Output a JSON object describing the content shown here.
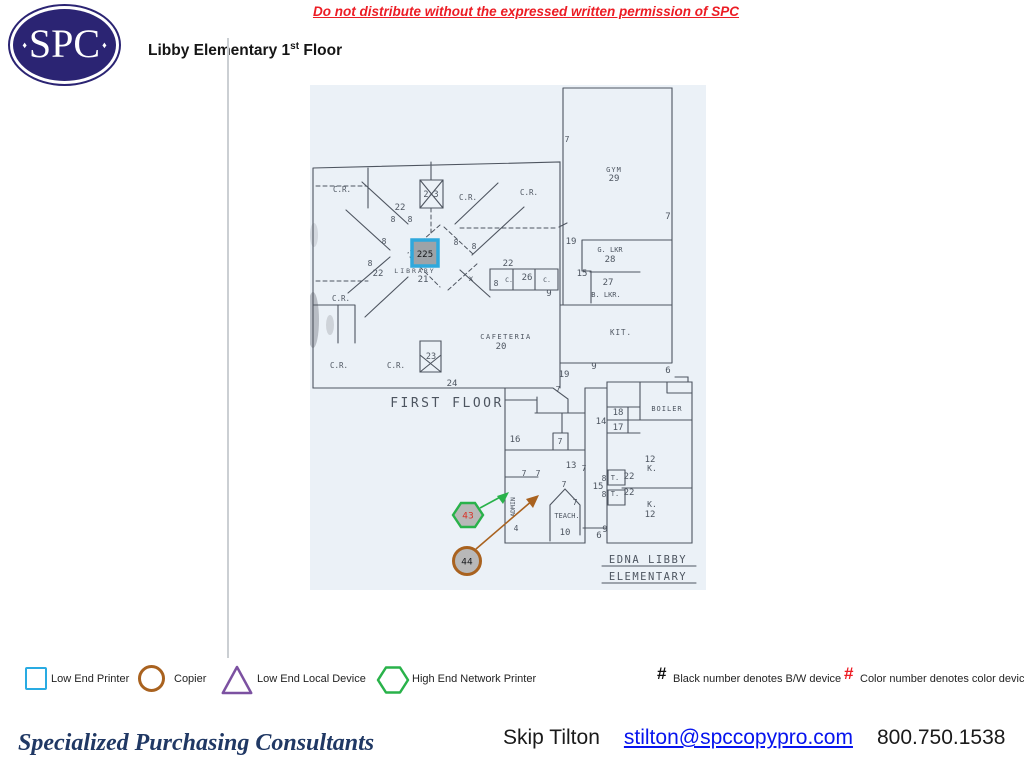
{
  "header": {
    "warning": "Do not distribute without the expressed written permission of SPC",
    "logo": {
      "text": "SPC",
      "diamond": "♦"
    },
    "title": {
      "prefix": "Libby Elementary 1",
      "sup": "st",
      "suffix": " Floor"
    }
  },
  "plan": {
    "caption": "FIRST FLOOR",
    "school_line1": "EDNA LIBBY",
    "school_line2": "ELEMENTARY",
    "highlight": {
      "label": "225"
    },
    "markers": {
      "hexagon_number": "43",
      "circle_number": "44"
    },
    "labels": [
      {
        "t": "7",
        "x": 257,
        "y": 57,
        "s": 8
      },
      {
        "t": "GYM",
        "x": 304,
        "y": 87,
        "s": 7,
        "ls": 1
      },
      {
        "t": "29",
        "x": 304,
        "y": 96,
        "s": 9
      },
      {
        "t": "7",
        "x": 358,
        "y": 134,
        "s": 9
      },
      {
        "t": "19",
        "x": 261,
        "y": 159,
        "s": 9
      },
      {
        "t": "G. LKR",
        "x": 300,
        "y": 167,
        "s": 7
      },
      {
        "t": "28",
        "x": 300,
        "y": 177,
        "s": 9
      },
      {
        "t": "15",
        "x": 272,
        "y": 191,
        "s": 9
      },
      {
        "t": "27",
        "x": 298,
        "y": 200,
        "s": 9
      },
      {
        "t": "B. LKR.",
        "x": 296,
        "y": 212,
        "s": 7
      },
      {
        "t": "KIT.",
        "x": 311,
        "y": 250,
        "s": 7.5,
        "ls": 1
      },
      {
        "t": "9",
        "x": 284,
        "y": 284,
        "s": 9
      },
      {
        "t": "6",
        "x": 358,
        "y": 288,
        "s": 9
      },
      {
        "t": "19",
        "x": 254,
        "y": 292,
        "s": 9
      },
      {
        "t": "C.R.",
        "x": 32,
        "y": 107,
        "s": 7.5
      },
      {
        "t": "2-3",
        "x": 121,
        "y": 112,
        "s": 8.5
      },
      {
        "t": "C.R.",
        "x": 158,
        "y": 115,
        "s": 7.5
      },
      {
        "t": "C.R.",
        "x": 219,
        "y": 110,
        "s": 7.5
      },
      {
        "t": "22",
        "x": 90,
        "y": 125,
        "s": 9
      },
      {
        "t": "8",
        "x": 83,
        "y": 137,
        "s": 8
      },
      {
        "t": "8",
        "x": 100,
        "y": 137,
        "s": 8
      },
      {
        "t": "8",
        "x": 74,
        "y": 159,
        "s": 8
      },
      {
        "t": "8",
        "x": 146,
        "y": 160,
        "s": 8
      },
      {
        "t": "8",
        "x": 164,
        "y": 164,
        "s": 8
      },
      {
        "t": "C.R.",
        "x": 31,
        "y": 216,
        "s": 7.5
      },
      {
        "t": "LIBRARY",
        "x": 105,
        "y": 188,
        "s": 6.5,
        "ls": 2
      },
      {
        "t": "21",
        "x": 113,
        "y": 197,
        "s": 9
      },
      {
        "t": "8",
        "x": 60,
        "y": 181,
        "s": 8
      },
      {
        "t": "22",
        "x": 68,
        "y": 191,
        "s": 9
      },
      {
        "t": "x",
        "x": 161,
        "y": 196,
        "s": 8
      },
      {
        "t": "22",
        "x": 198,
        "y": 181,
        "s": 9
      },
      {
        "t": "8",
        "x": 186,
        "y": 201,
        "s": 8
      },
      {
        "t": "C.",
        "x": 199,
        "y": 197,
        "s": 6.5
      },
      {
        "t": "26",
        "x": 217,
        "y": 195,
        "s": 9
      },
      {
        "t": "C.",
        "x": 237,
        "y": 197,
        "s": 6.5
      },
      {
        "t": "9",
        "x": 239,
        "y": 211,
        "s": 9
      },
      {
        "t": "C.R.",
        "x": 29,
        "y": 283,
        "s": 7.5
      },
      {
        "t": "C.R.",
        "x": 86,
        "y": 283,
        "s": 7.5
      },
      {
        "t": "23",
        "x": 121,
        "y": 274,
        "s": 8.5
      },
      {
        "t": "CAFETERIA",
        "x": 196,
        "y": 254,
        "s": 7,
        "ls": 1.5
      },
      {
        "t": "20",
        "x": 191,
        "y": 264,
        "s": 9
      },
      {
        "t": "24",
        "x": 142,
        "y": 301,
        "s": 9
      },
      {
        "t": "7",
        "x": 248,
        "y": 307,
        "s": 8
      },
      {
        "t": "16",
        "x": 205,
        "y": 357,
        "s": 9
      },
      {
        "t": "7",
        "x": 250,
        "y": 359,
        "s": 8
      },
      {
        "t": "13",
        "x": 261,
        "y": 383,
        "s": 9
      },
      {
        "t": "7",
        "x": 274,
        "y": 386,
        "s": 8
      },
      {
        "t": "7",
        "x": 214,
        "y": 391,
        "s": 8
      },
      {
        "t": "7",
        "x": 228,
        "y": 391,
        "s": 8
      },
      {
        "t": "7",
        "x": 254,
        "y": 402,
        "s": 8
      },
      {
        "t": "7",
        "x": 265,
        "y": 420,
        "s": 8
      },
      {
        "t": "TEACH.",
        "x": 257,
        "y": 433,
        "s": 7
      },
      {
        "t": "10",
        "x": 255,
        "y": 450,
        "s": 9
      },
      {
        "t": "ADMIN",
        "x": 205,
        "y": 422,
        "s": 6.5,
        "rot": -90
      },
      {
        "t": "4",
        "x": 206,
        "y": 446,
        "s": 8
      },
      {
        "t": "9",
        "x": 295,
        "y": 447,
        "s": 9
      },
      {
        "t": "6",
        "x": 289,
        "y": 453,
        "s": 9
      },
      {
        "t": "14",
        "x": 291,
        "y": 339,
        "s": 9
      },
      {
        "t": "18",
        "x": 308,
        "y": 330,
        "s": 9
      },
      {
        "t": "17",
        "x": 308,
        "y": 345,
        "s": 9
      },
      {
        "t": "BOILER",
        "x": 357,
        "y": 326,
        "s": 7,
        "ls": 1
      },
      {
        "t": "12",
        "x": 340,
        "y": 377,
        "s": 9
      },
      {
        "t": "K.",
        "x": 342,
        "y": 386,
        "s": 8
      },
      {
        "t": "8",
        "x": 294,
        "y": 396,
        "s": 8
      },
      {
        "t": "T.",
        "x": 305,
        "y": 395,
        "s": 7
      },
      {
        "t": "22",
        "x": 319,
        "y": 394,
        "s": 9
      },
      {
        "t": "15",
        "x": 288,
        "y": 404,
        "s": 9
      },
      {
        "t": "8",
        "x": 294,
        "y": 412,
        "s": 8
      },
      {
        "t": "T.",
        "x": 305,
        "y": 411,
        "s": 7
      },
      {
        "t": "22",
        "x": 319,
        "y": 410,
        "s": 9
      },
      {
        "t": "K.",
        "x": 342,
        "y": 422,
        "s": 8
      },
      {
        "t": "12",
        "x": 340,
        "y": 432,
        "s": 9
      }
    ]
  },
  "legend": {
    "items": [
      {
        "shape": "square",
        "label": "Low End Printer",
        "color": "#29ABE2"
      },
      {
        "shape": "circle",
        "label": "Copier",
        "color": "#A9621F"
      },
      {
        "shape": "triangle",
        "label": "Low End Local Device",
        "color": "#7C51A1"
      },
      {
        "shape": "hexagon",
        "label": "High End Network Printer",
        "color": "#29B24A"
      }
    ],
    "notes": [
      {
        "symbol": "#",
        "symbol_color": "#111111",
        "text": "Black number denotes B/W device"
      },
      {
        "symbol": "#",
        "symbol_color": "#ED1C24",
        "text": "Color number denotes color device"
      }
    ]
  },
  "footer": {
    "company": "Specialized Purchasing Consultants",
    "contact": "Skip Tilton",
    "email": "stilton@spccopypro.com",
    "phone": "800.750.1538"
  },
  "colors": {
    "warning_red": "#EC1C24",
    "logo_navy": "#2B2473",
    "printer_blue": "#29ABE2",
    "copier_brown": "#A9621F",
    "device_purple": "#7C51A1",
    "network_green": "#29B24A",
    "note_red": "#ED1C24",
    "company_navy": "#203864",
    "link_blue": "#0714EE",
    "marker_number_red": "#D93025",
    "highlight_blue": "#2FA8DC"
  }
}
